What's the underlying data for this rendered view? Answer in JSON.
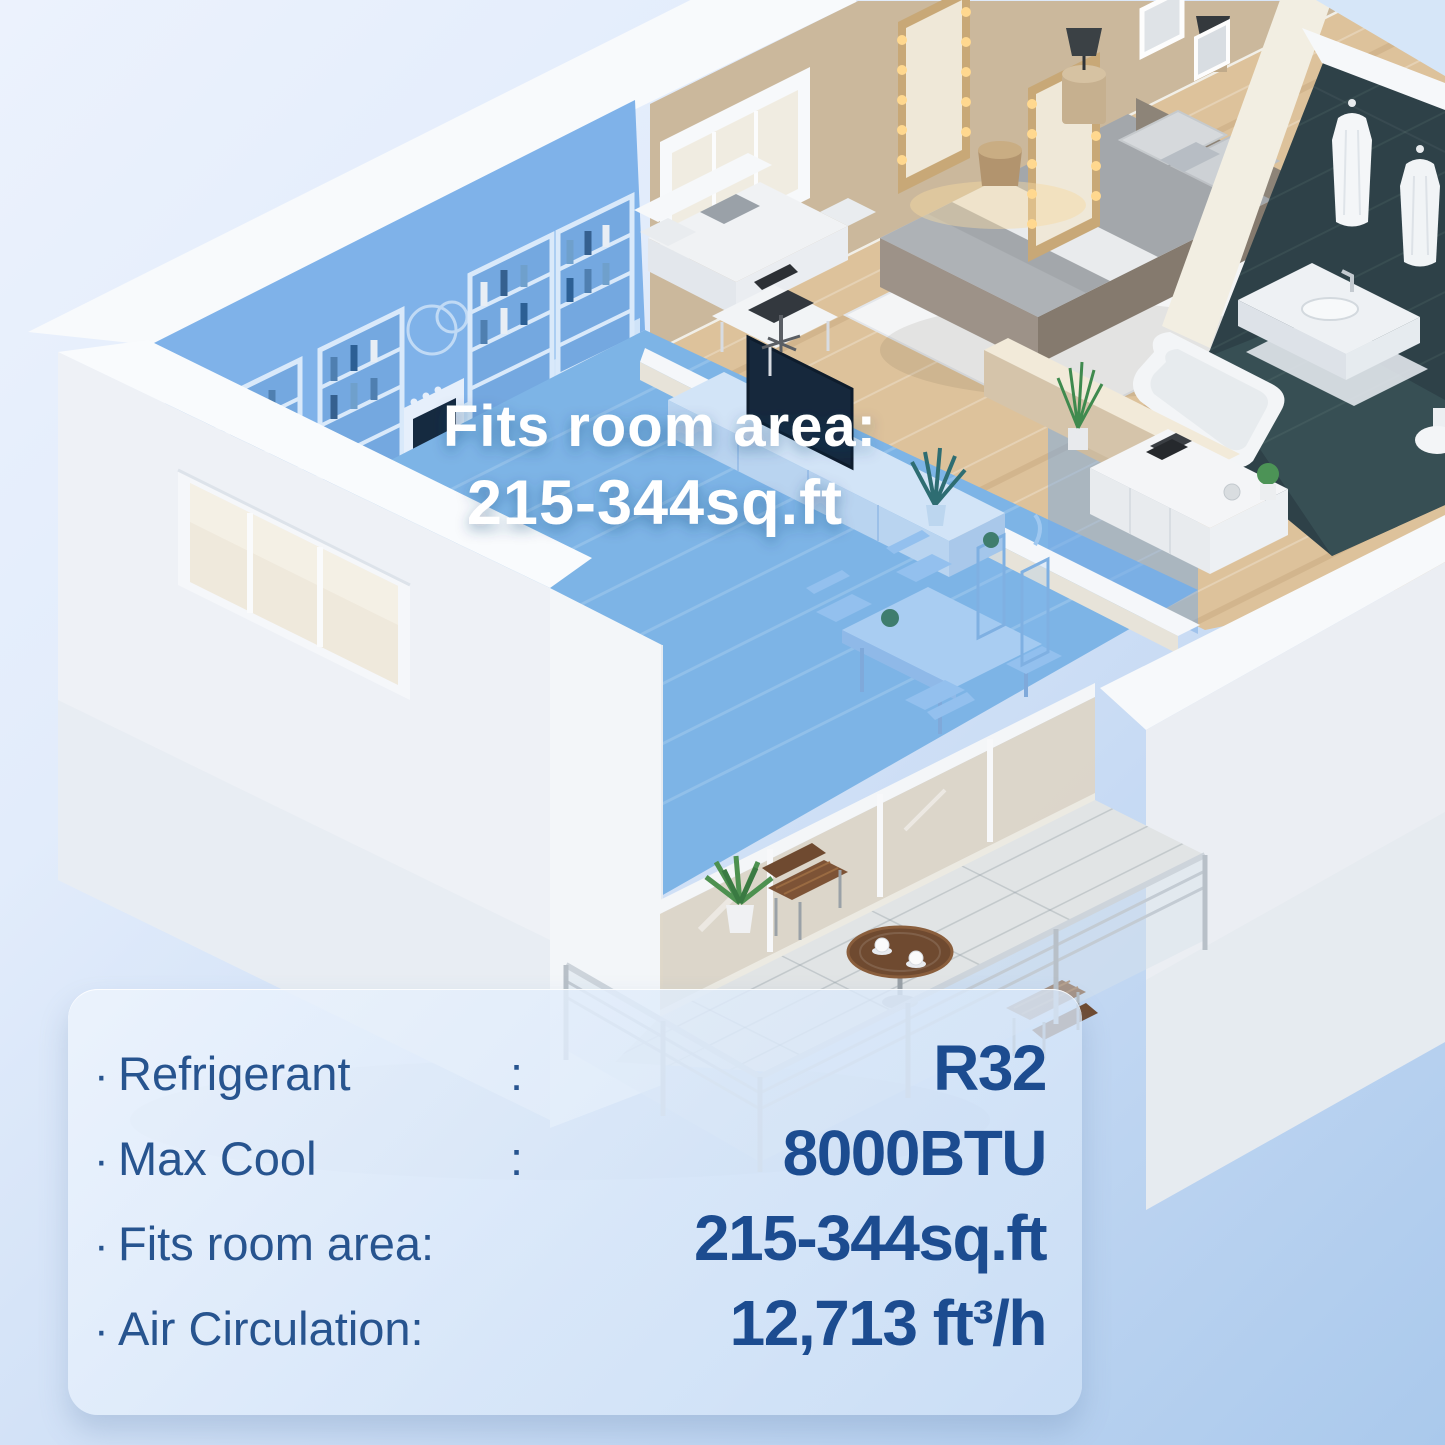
{
  "background": {
    "top_color": "#ecf2fd",
    "bottom_color": "#aac9ec"
  },
  "floor_plan": {
    "highlight_color": "#6FA8E0",
    "caption": {
      "line1": "Fits room area:",
      "line2": "215-344sq.ft",
      "color": "#ffffff"
    }
  },
  "spec_panel": {
    "bullet": "·",
    "label_color": "#27548f",
    "value_color": "#1c4c90",
    "rows": [
      {
        "label": "Refrigerant",
        "colon": ":",
        "value": "R32"
      },
      {
        "label": "Max Cool",
        "colon": ":",
        "value": "8000BTU"
      },
      {
        "label": "Fits room area:",
        "colon": "",
        "value": "215-344sq.ft"
      },
      {
        "label": "Air Circulation:",
        "colon": "",
        "value": "12,713 ft³/h"
      }
    ]
  }
}
